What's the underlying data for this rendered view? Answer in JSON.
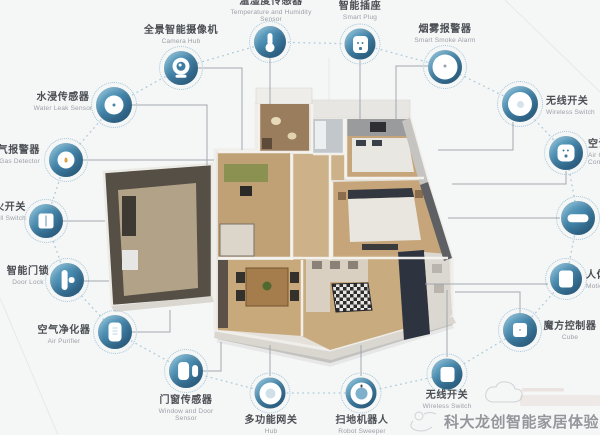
{
  "watermark": {
    "text": "科大龙创智能家居体验"
  },
  "devices": [
    {
      "id": "water-leak-sensor",
      "zh": "水浸传感器",
      "en": "Water Leak Sensor"
    },
    {
      "id": "camera-hub",
      "zh": "全景智能摄像机",
      "en": "Camera Hub"
    },
    {
      "id": "temperature-humidity-sensor",
      "zh": "温湿度传感器",
      "en": "Temperature and Humidity Sensor"
    },
    {
      "id": "smart-plug",
      "zh": "智能插座",
      "en": "Smart Plug"
    },
    {
      "id": "smart-smoke-alarm",
      "zh": "烟雾报警器",
      "en": "Smart Smoke Alarm"
    },
    {
      "id": "wireless-switch-right",
      "zh": "无线开关",
      "en": "Wireless Switch"
    },
    {
      "id": "air-conditioning-companion",
      "zh": "空调伴侣",
      "en": "Air Conditioning Companion"
    },
    {
      "id": "edge-device",
      "zh": "",
      "en": ""
    },
    {
      "id": "motion-sensor",
      "zh": "人体传感器",
      "en": "Motion Sensor"
    },
    {
      "id": "cube-controller",
      "zh": "魔方控制器",
      "en": "Cube"
    },
    {
      "id": "wireless-switch-bottom",
      "zh": "无线开关",
      "en": "Wireless Switch"
    },
    {
      "id": "robot-sweeper",
      "zh": "扫地机器人",
      "en": "Robot Sweeper"
    },
    {
      "id": "hub",
      "zh": "多功能网关",
      "en": "Hub"
    },
    {
      "id": "window-door-sensor",
      "zh": "门窗传感器",
      "en": "Window and Door Sensor"
    },
    {
      "id": "air-purifier",
      "zh": "空气净化器",
      "en": "Air Purifier"
    },
    {
      "id": "door-lock",
      "zh": "智能门锁",
      "en": "Door Lock"
    },
    {
      "id": "wall-switch",
      "zh": "单火开关",
      "en": "Wall Switch"
    },
    {
      "id": "natural-gas-detector",
      "zh": "燃气报警器",
      "en": "Natural Gas Detector"
    }
  ],
  "colors": {
    "icon_blue": "#4689af",
    "icon_blue_dark": "#34688c",
    "dotted_ring": "#a4c5d7",
    "dotted_chain": "#afccdc",
    "connector_gray": "#9aa2a8",
    "background": "#f5f6f6",
    "label_dark": "#4b4f54",
    "label_gray": "#9ba1a7",
    "watermark_gray": "#8b9095",
    "floor_wood": "#c6a57a"
  }
}
